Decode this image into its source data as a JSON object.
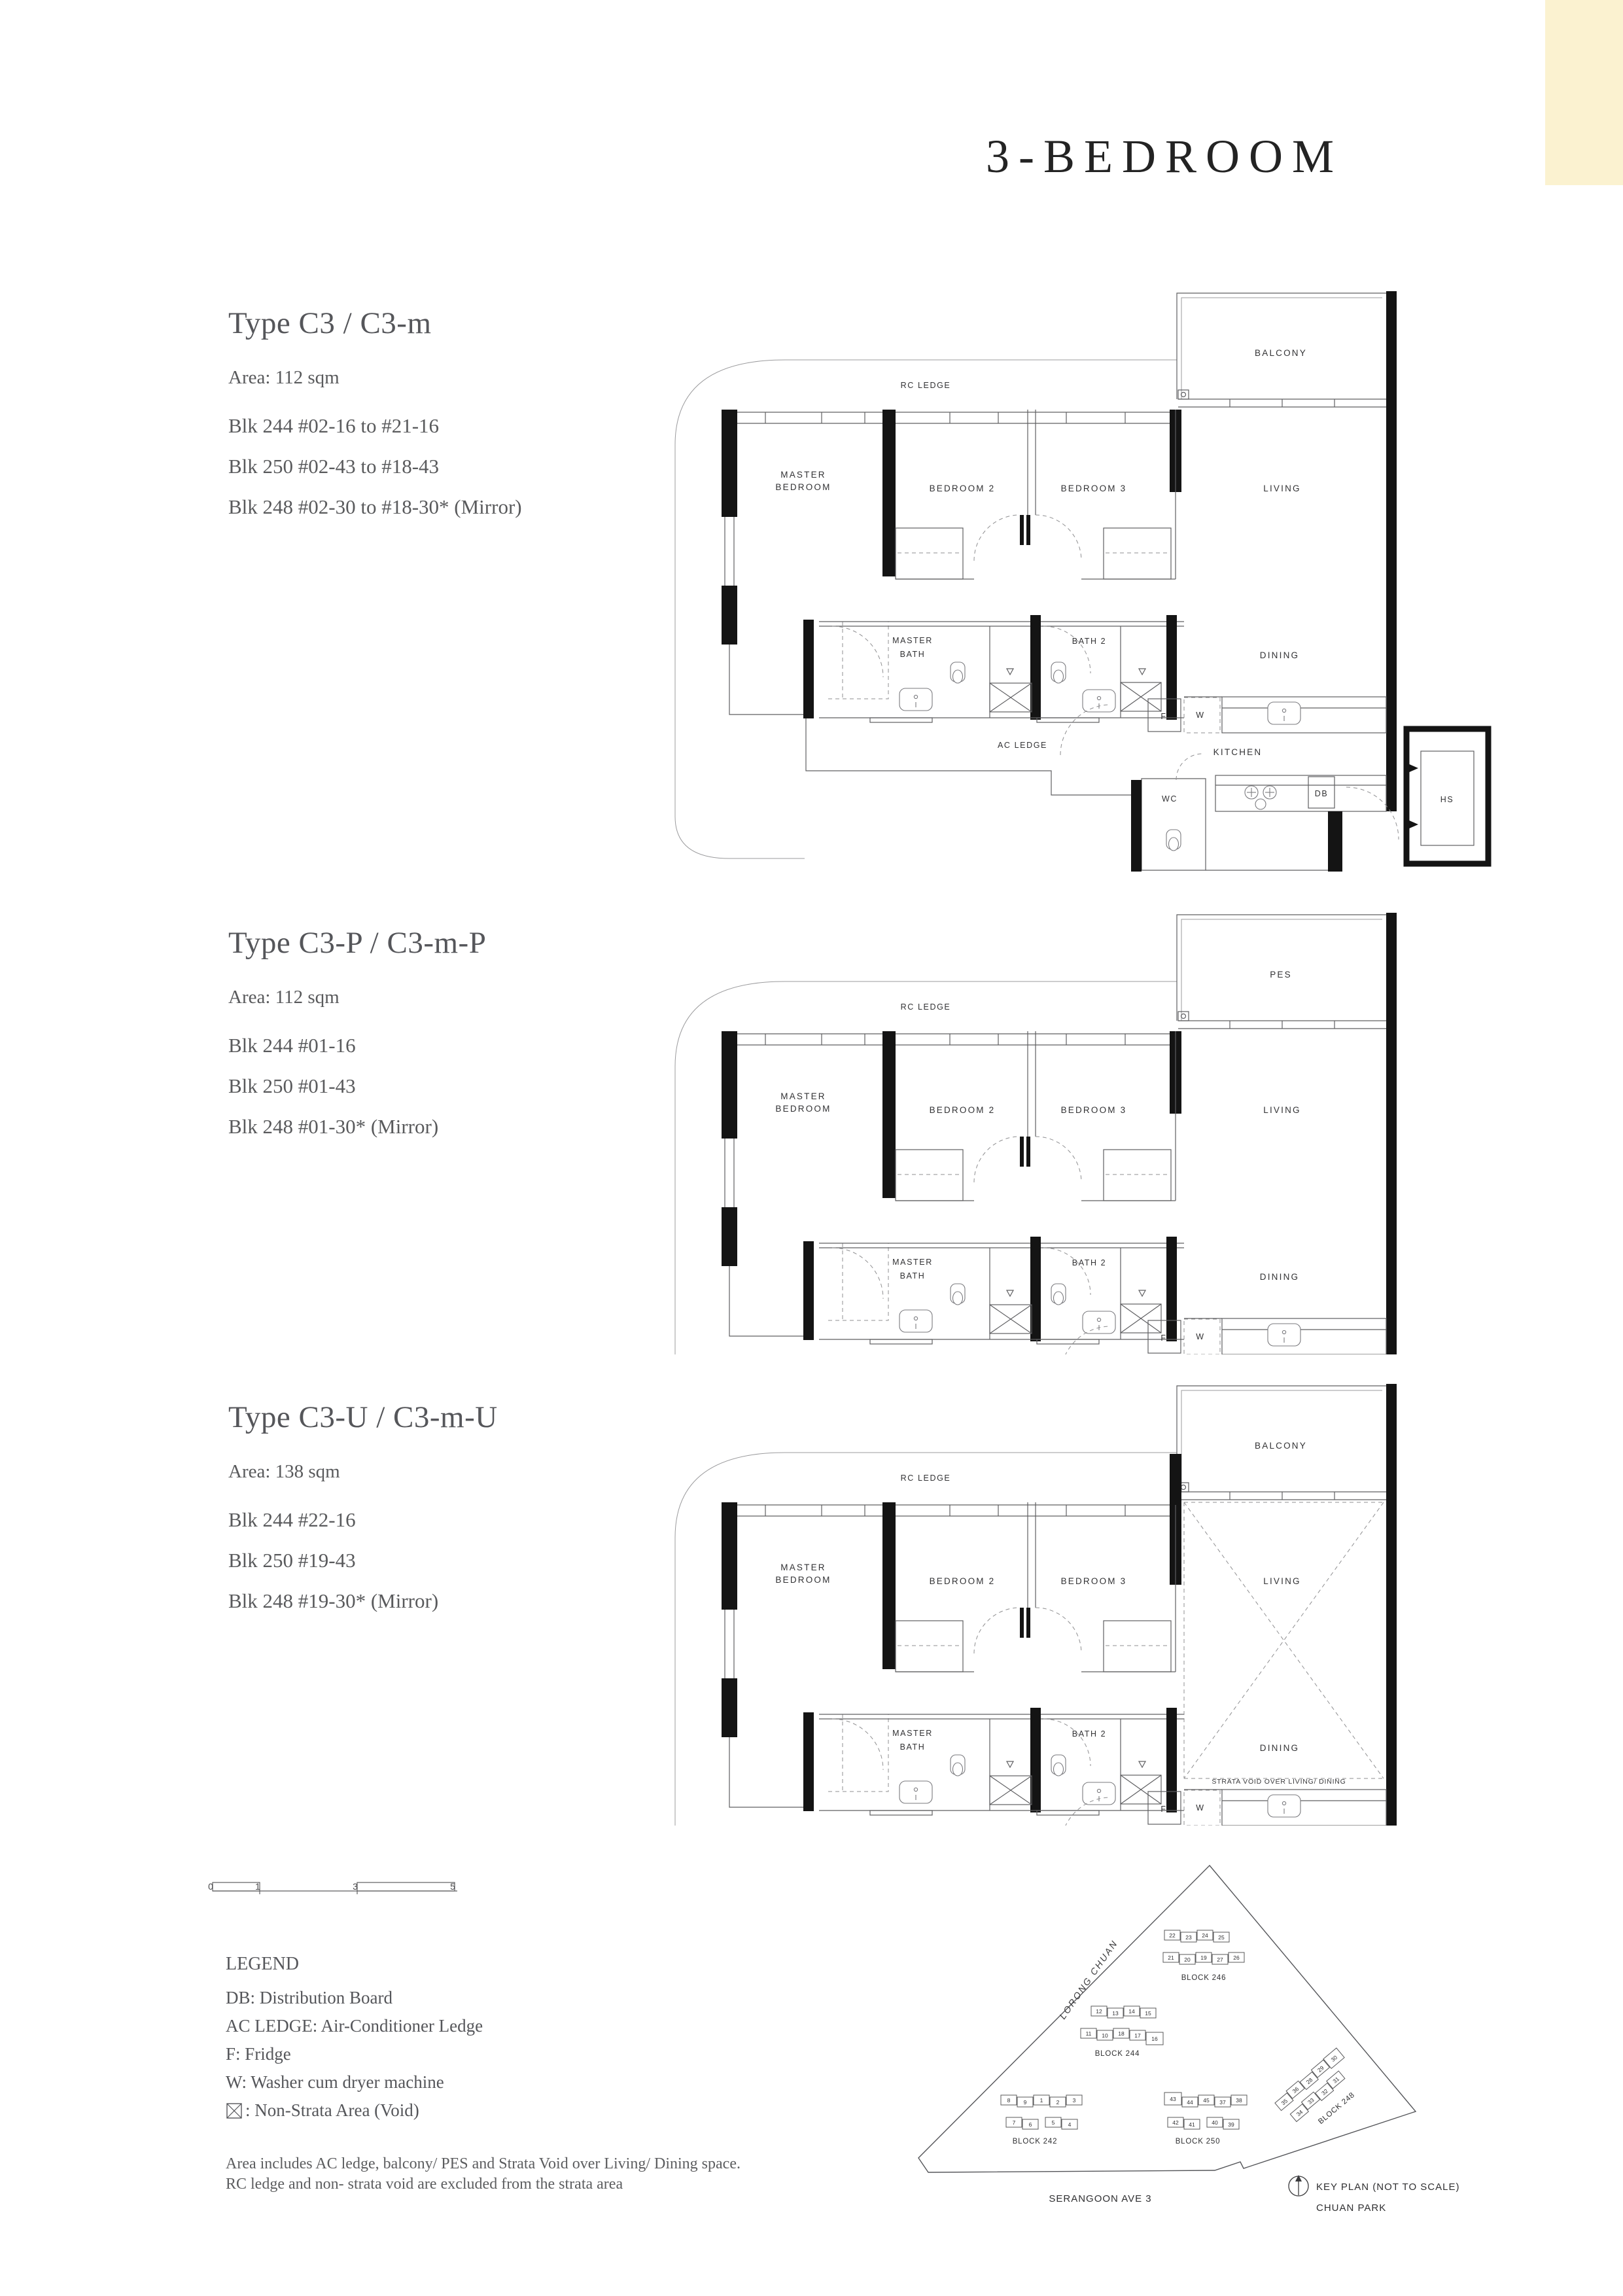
{
  "page_title": "3-BEDROOM",
  "colors": {
    "cream_band": "#FBF2D0",
    "keyplan_highlight": "#F5E8C0"
  },
  "types": [
    {
      "name": "Type C3 / C3-m",
      "area": "Area: 112 sqm",
      "blocks": [
        "Blk 244  #02-16 to #21-16",
        "Blk 250  #02-43 to #18-43",
        "Blk 248  #02-30 to #18-30* (Mirror)"
      ]
    },
    {
      "name": "Type C3-P / C3-m-P",
      "area": "Area: 112 sqm",
      "blocks": [
        "Blk 244  #01-16",
        "Blk 250  #01-43",
        "Blk 248  #01-30* (Mirror)"
      ]
    },
    {
      "name": "Type C3-U / C3-m-U",
      "area": "Area: 138 sqm",
      "blocks": [
        "Blk 244  #22-16",
        "Blk 250  #19-43",
        "Blk 248  #19-30* (Mirror)"
      ]
    }
  ],
  "plan_labels": {
    "rc_ledge": "RC LEDGE",
    "balcony": "BALCONY",
    "pes": "PES",
    "master_bedroom_1": "MASTER",
    "master_bedroom_2": "BEDROOM",
    "bedroom2": "BEDROOM 2",
    "bedroom3": "BEDROOM 3",
    "living": "LIVING",
    "dining": "DINING",
    "master_bath_1": "MASTER",
    "master_bath_2": "BATH",
    "bath2": "BATH 2",
    "ac_ledge": "AC LEDGE",
    "kitchen": "KITCHEN",
    "wc": "WC",
    "db": "DB",
    "hs": "HS",
    "f": "F",
    "w": "W",
    "strata_void": "STRATA VOID OVER LIVING/ DINING"
  },
  "scale_bar": {
    "ticks": [
      "0",
      "1",
      "3",
      "5"
    ]
  },
  "legend": {
    "title": "LEGEND",
    "items": [
      "DB: Distribution Board",
      "AC LEDGE: Air-Conditioner Ledge",
      "F: Fridge",
      "W: Washer cum dryer machine",
      ": Non-Strata Area (Void)"
    ]
  },
  "footnote": [
    "Area includes AC ledge, balcony/ PES and Strata Void over Living/ Dining space.",
    "RC ledge and non- strata void are excluded from the strata area"
  ],
  "keyplan": {
    "roads": {
      "lorong_chuan": "LORONG CHUAN",
      "serangoon": "SERANGOON AVE 3"
    },
    "caption": [
      "KEY PLAN (NOT TO SCALE)",
      "CHUAN PARK"
    ],
    "blocks": [
      {
        "label": "BLOCK 246",
        "rows": [
          [
            "22",
            "23",
            "24",
            "25"
          ],
          [
            "21",
            "20",
            "19",
            "27",
            "26"
          ]
        ]
      },
      {
        "label": "BLOCK 244",
        "rows": [
          [
            "12",
            "13",
            "14",
            "15"
          ],
          [
            "11",
            "10",
            "18",
            "17",
            "16"
          ]
        ]
      },
      {
        "label": "BLOCK 242",
        "rows": [
          [
            "8",
            "9",
            "1",
            "2",
            "3"
          ],
          [
            "7",
            "6",
            "5",
            "4"
          ]
        ]
      },
      {
        "label": "BLOCK 250",
        "rows": [
          [
            "43",
            "44",
            "45",
            "37",
            "38"
          ],
          [
            "42",
            "41",
            "40",
            "39"
          ]
        ]
      },
      {
        "label": "BLOCK 248",
        "rows": [
          [
            "35",
            "36",
            "28",
            "29",
            "30"
          ],
          [
            "34",
            "33",
            "32",
            "31"
          ]
        ]
      }
    ]
  }
}
